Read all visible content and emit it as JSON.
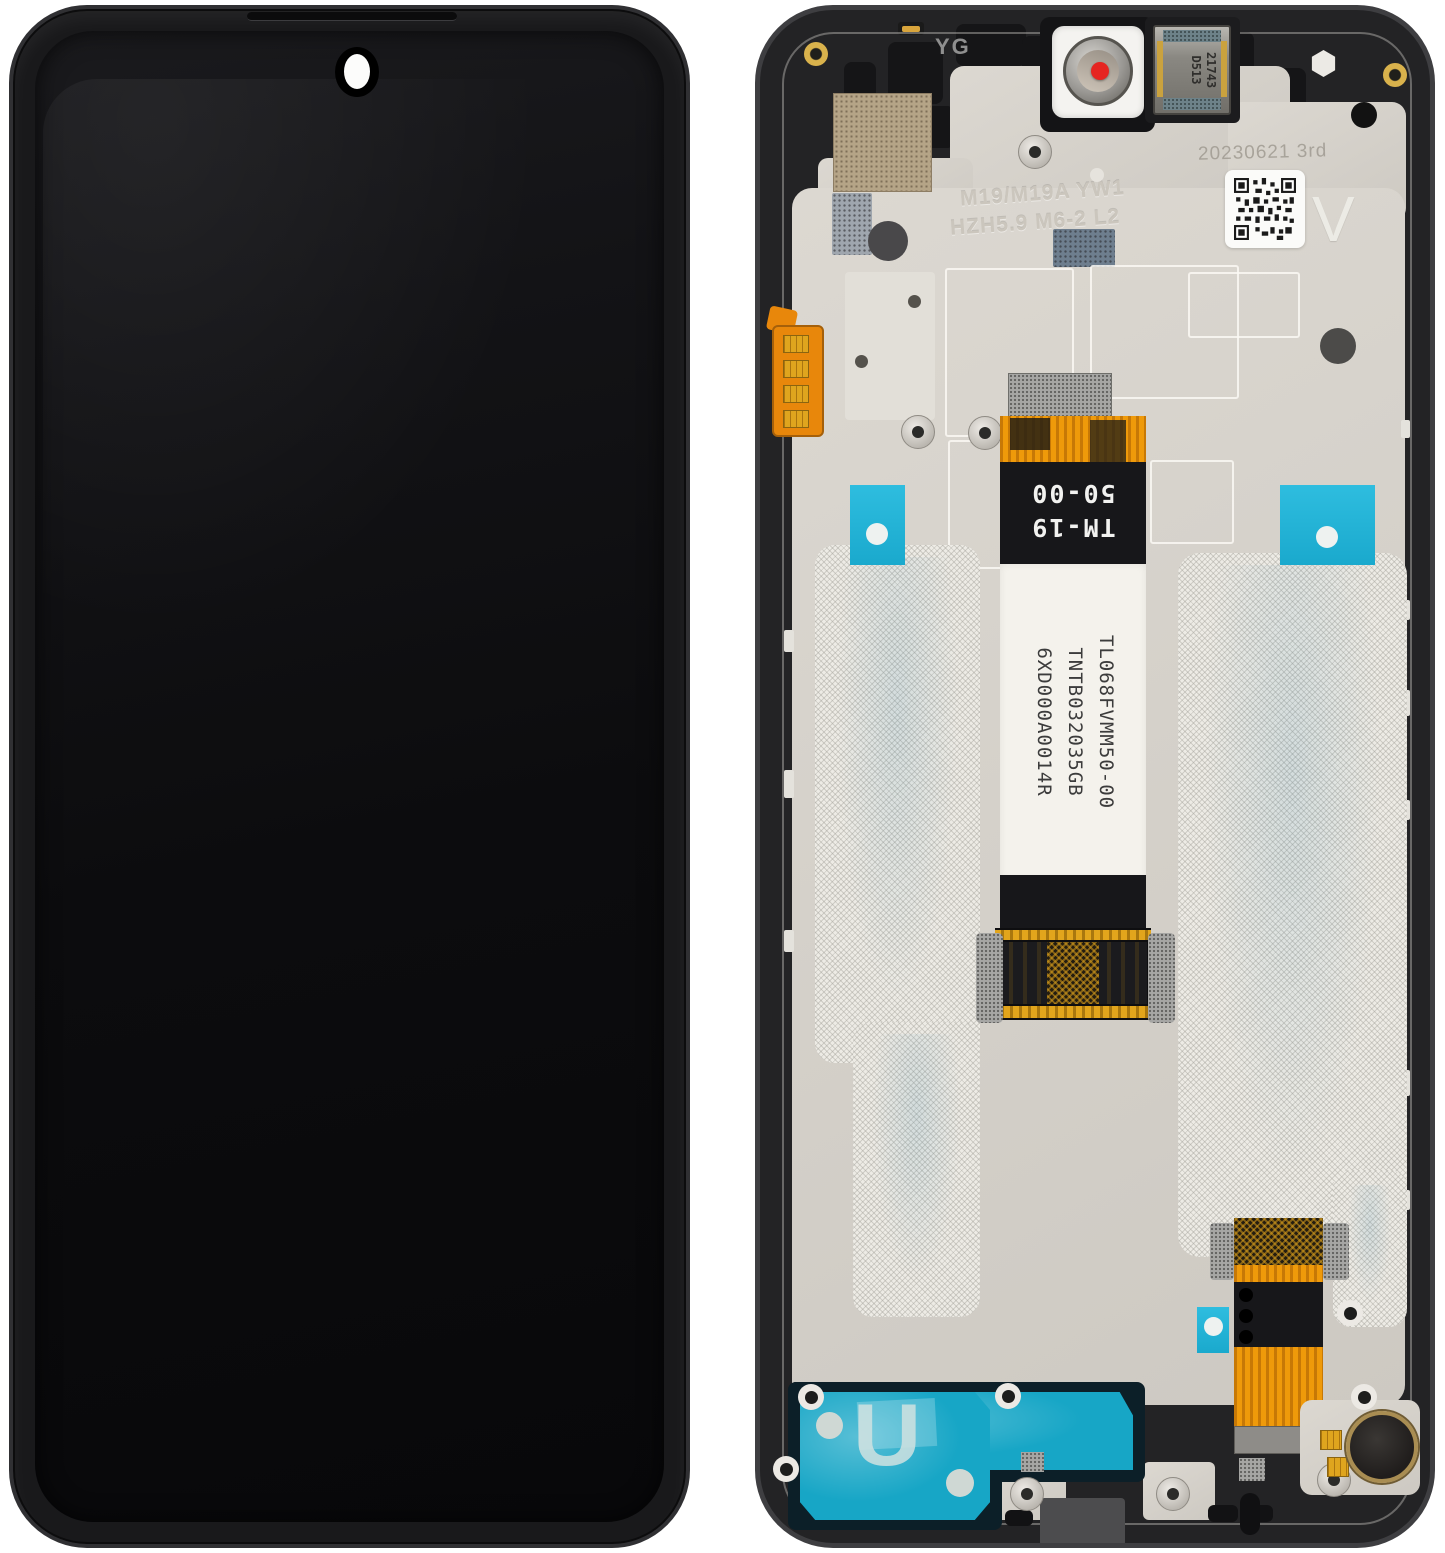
{
  "back": {
    "frame_code": "YG",
    "speaker_marking": [
      "D513",
      "21743"
    ],
    "date_stamp": "20230621 3rd",
    "version_letter": "V",
    "etched_model_line1": "M19/M19A YW1",
    "etched_model_line2": "HZH5.9 M6-2 L2",
    "flex_code_line1": "TM-19",
    "flex_code_line2": "50-00",
    "label_codes": [
      "TL068FVMM50-00",
      "TNTB032035GB",
      "6XD000A0014R"
    ],
    "adhesive_letter": "U"
  },
  "colors": {
    "frame": "#232325",
    "screen": "#0a0a0c",
    "plate": "#d6d2cb",
    "navy_pad": "#0d2433",
    "cyan_tab": "#1fb2d8",
    "teal_adhesive": "#17a6c6",
    "flex_orange": "#ef9a0a",
    "gold": "#d9b24c",
    "camera_dot_red": "#e8242a"
  }
}
